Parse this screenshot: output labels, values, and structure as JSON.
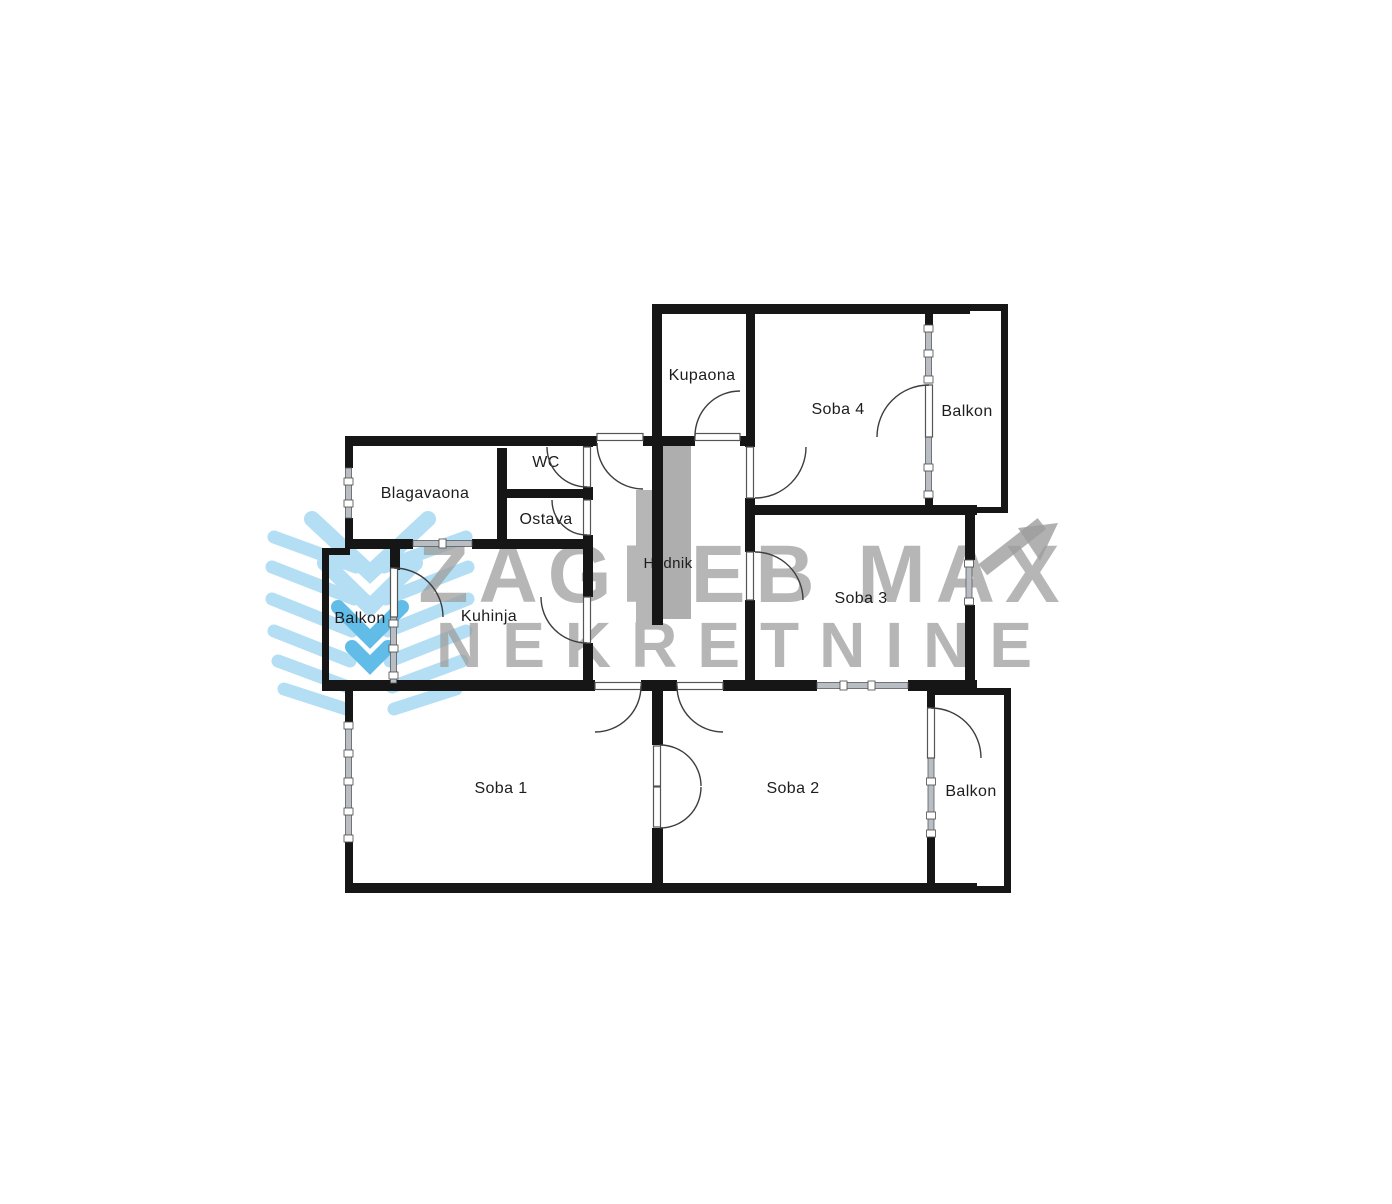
{
  "title": "Apartment floor plan",
  "labels": {
    "kupaona": "Kupaona",
    "soba4": "Soba 4",
    "balkon_tr": "Balkon",
    "wc": "WC",
    "blagavaona": "Blagavaona",
    "ostava": "Ostava",
    "hodnik": "Hodnik",
    "soba3": "Soba 3",
    "balkon_l": "Balkon",
    "kuhinja": "Kuhinja",
    "soba1": "Soba 1",
    "soba2": "Soba 2",
    "balkon_br": "Balkon"
  },
  "watermark": {
    "line1": "ZAGREB MAX",
    "line2": "NEKRETNINE"
  },
  "colors": {
    "wall": "#161616",
    "window": "#b9bec4",
    "closet_light": "#b6b6b6",
    "closet_dark": "#aeaeae",
    "watermark_gray": "#9e9e9e",
    "logo_blue": "#a6d9f2",
    "logo_blue_dark": "#46b1e3",
    "label": "#1d1d1d"
  }
}
